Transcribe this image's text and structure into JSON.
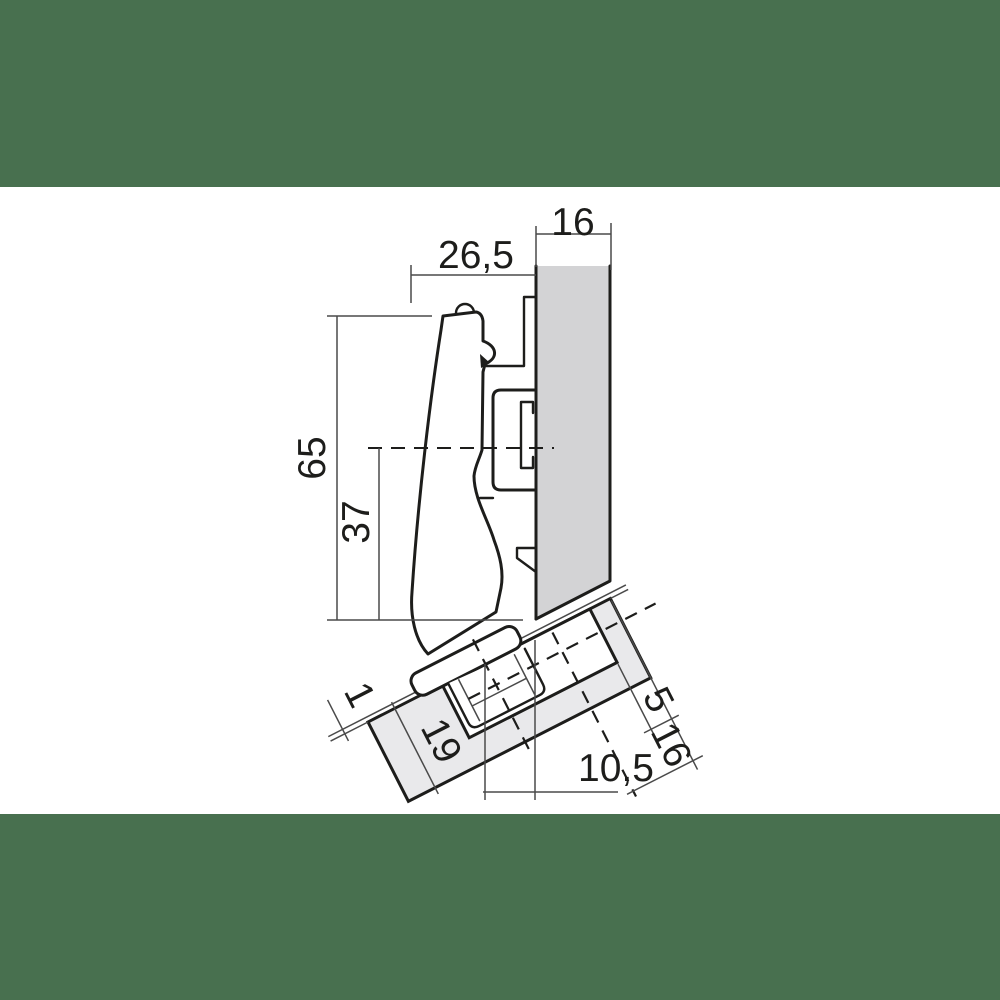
{
  "drawing": {
    "kind": "technical-dimension-drawing",
    "subject": "concealed cabinet hinge cross-section mounted between a cabinet side panel and an angled door"
  },
  "colors": {
    "band": "#48704f",
    "background": "#ffffff",
    "panel_fill": "#d3d3d5",
    "door_fill": "#e9e9eb",
    "line": "#1d1d1b",
    "dim_line": "#4a4a4a"
  },
  "dimensions": {
    "panel_thickness": "16",
    "arm_projection": "26,5",
    "overall_height": "65",
    "axis_height": "37",
    "gap": "1",
    "door_thickness": "19",
    "cup_center_distance": "10,5",
    "cup_edge_distance": "5",
    "door_edge_distance": "16"
  }
}
